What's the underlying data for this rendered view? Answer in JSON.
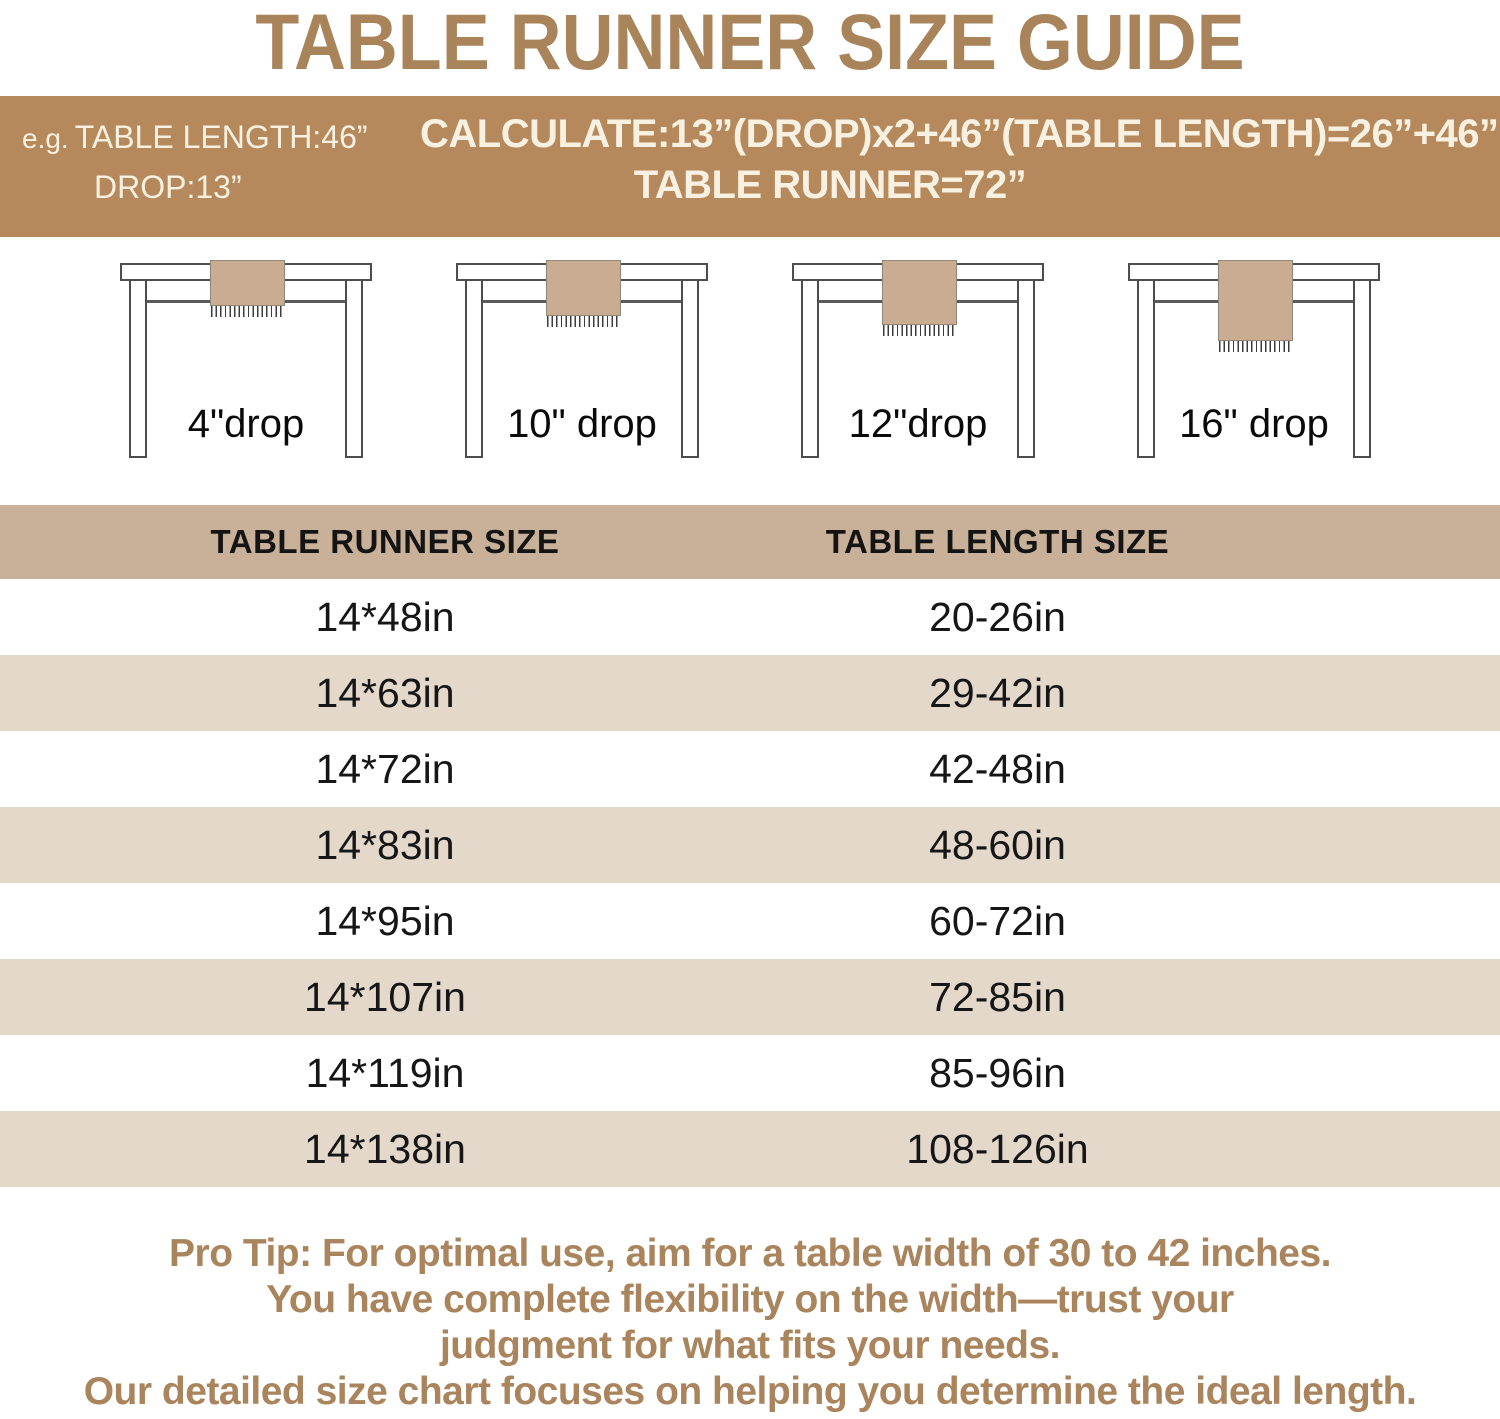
{
  "title": "TABLE RUNNER SIZE GUIDE",
  "banner": {
    "eg_prefix": "e.g.",
    "example_line1": "TABLE LENGTH:46”",
    "example_line2": "DROP:13”",
    "calc_line1": "CALCULATE:13”(DROP)x2+46”(TABLE LENGTH)=26”+46”",
    "calc_line2": "TABLE RUNNER=72”"
  },
  "illustrations": [
    {
      "label": "4\"drop",
      "drop_inches": 4
    },
    {
      "label": "10\" drop",
      "drop_inches": 10
    },
    {
      "label": "12\"drop",
      "drop_inches": 12
    },
    {
      "label": "16\" drop",
      "drop_inches": 16
    }
  ],
  "size_table": {
    "columns": [
      "TABLE RUNNER SIZE",
      "TABLE LENGTH SIZE"
    ],
    "rows": [
      {
        "runner_size": "14*48in",
        "table_length": "20-26in"
      },
      {
        "runner_size": "14*63in",
        "table_length": "29-42in"
      },
      {
        "runner_size": "14*72in",
        "table_length": "42-48in"
      },
      {
        "runner_size": "14*83in",
        "table_length": "48-60in"
      },
      {
        "runner_size": "14*95in",
        "table_length": "60-72in"
      },
      {
        "runner_size": "14*107in",
        "table_length": "72-85in"
      },
      {
        "runner_size": "14*119in",
        "table_length": "85-96in"
      },
      {
        "runner_size": "14*138in",
        "table_length": "108-126in"
      }
    ]
  },
  "pro_tip": {
    "lines": [
      "Pro Tip: For optimal use, aim for a table width of 30 to 42 inches.",
      "You have complete flexibility on the width—trust your",
      "judgment for what fits your needs.",
      "Our detailed size chart focuses on helping you determine the ideal length."
    ]
  },
  "colors": {
    "accent_brown": "#a9845a",
    "banner_background": "#b5895c",
    "banner_text": "#f8f1e2",
    "header_row_background": "#c9b098",
    "alt_row_background": "#e4d8cb",
    "runner_fill": "#c9ac92",
    "outline": "#4d4d4d"
  }
}
